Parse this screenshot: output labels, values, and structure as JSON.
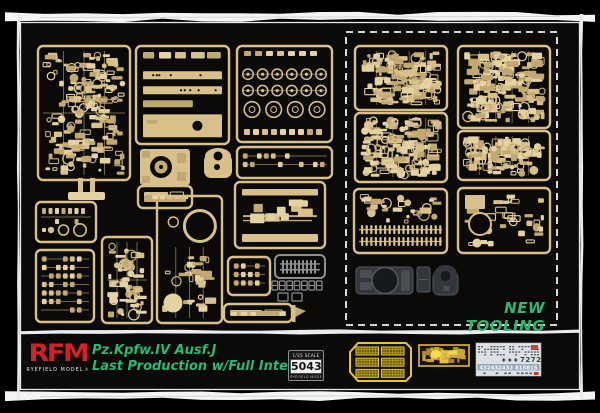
{
  "colors": {
    "background": "#000000",
    "panel": "#0b0a08",
    "sprue_tan": "#d8c08a",
    "sprue_tan_light": "#e5d2a3",
    "sprue_tan_dark": "#c2a971",
    "sprue_gray": "#8f8f8f",
    "dark_part": "#33363a",
    "dark_part_light": "#4a4e54",
    "frame_white": "#f4f4f4",
    "green": "#2db873",
    "red": "#d22128",
    "pe_yellow": "#e3c431",
    "pe_gold": "#c9a53b",
    "decal_bg": "#dce1e6",
    "decal_band": "#92a9bb",
    "decal_ink": "#3a4046",
    "decal_red": "#c63434"
  },
  "panel": {
    "new_tooling_label": "NEW TOOLING",
    "dashed_box": {
      "x": 346,
      "y": 32,
      "w": 211,
      "h": 293
    },
    "sprues": [
      {
        "id": "A",
        "x": 38,
        "y": 46,
        "w": 92,
        "h": 134,
        "kind": "mixed",
        "color": "tan",
        "seed": 1
      },
      {
        "id": "B",
        "x": 136,
        "y": 46,
        "w": 93,
        "h": 98,
        "kind": "plates",
        "color": "tan",
        "seed": 2
      },
      {
        "id": "C",
        "x": 237,
        "y": 46,
        "w": 95,
        "h": 96,
        "kind": "wheels",
        "color": "tan",
        "seed": 3
      },
      {
        "id": "D",
        "x": 237,
        "y": 147,
        "w": 95,
        "h": 31,
        "kind": "tiny",
        "color": "tan",
        "seed": 4
      },
      {
        "id": "E",
        "x": 36,
        "y": 202,
        "w": 60,
        "h": 40,
        "kind": "small-circles",
        "color": "tan",
        "seed": 5
      },
      {
        "id": "F",
        "x": 36,
        "y": 250,
        "w": 58,
        "h": 72,
        "kind": "tiny",
        "color": "tan",
        "seed": 6
      },
      {
        "id": "G",
        "x": 102,
        "y": 237,
        "w": 50,
        "h": 86,
        "kind": "mixed",
        "color": "tan",
        "seed": 7
      },
      {
        "id": "H",
        "x": 157,
        "y": 196,
        "w": 65,
        "h": 127,
        "kind": "bigcircle",
        "color": "tan",
        "seed": 8
      },
      {
        "id": "I",
        "x": 235,
        "y": 182,
        "w": 90,
        "h": 66,
        "kind": "barrels",
        "color": "tan",
        "seed": 9
      },
      {
        "id": "J",
        "x": 228,
        "y": 257,
        "w": 42,
        "h": 38,
        "kind": "tiny",
        "color": "tan",
        "seed": 10
      },
      {
        "id": "K",
        "x": 138,
        "y": 186,
        "w": 54,
        "h": 22,
        "kind": "strips",
        "color": "tan",
        "seed": 11
      },
      {
        "id": "L",
        "x": 224,
        "y": 304,
        "w": 68,
        "h": 18,
        "kind": "strips",
        "color": "tan",
        "seed": 12
      },
      {
        "id": "M",
        "x": 275,
        "y": 255,
        "w": 50,
        "h": 23,
        "kind": "combs",
        "color": "gray",
        "seed": 13
      },
      {
        "id": "N1",
        "x": 355,
        "y": 46,
        "w": 92,
        "h": 64,
        "kind": "dense",
        "color": "tan",
        "seed": 14
      },
      {
        "id": "N2",
        "x": 458,
        "y": 46,
        "w": 92,
        "h": 82,
        "kind": "dense",
        "color": "tan",
        "seed": 15
      },
      {
        "id": "N3",
        "x": 355,
        "y": 113,
        "w": 92,
        "h": 69,
        "kind": "dense",
        "color": "tan",
        "seed": 16
      },
      {
        "id": "N4",
        "x": 458,
        "y": 131,
        "w": 92,
        "h": 49,
        "kind": "dense",
        "color": "tan",
        "seed": 17
      },
      {
        "id": "N5",
        "x": 354,
        "y": 189,
        "w": 93,
        "h": 64,
        "kind": "dense-combs",
        "color": "tan",
        "seed": 18
      },
      {
        "id": "N6",
        "x": 458,
        "y": 188,
        "w": 92,
        "h": 65,
        "kind": "dense-circle",
        "color": "tan",
        "seed": 19
      }
    ],
    "loose_parts": [
      {
        "type": "pedestal",
        "x": 68,
        "y": 178,
        "w": 37,
        "h": 22
      },
      {
        "type": "hull-top",
        "x": 140,
        "y": 149,
        "w": 50,
        "h": 36
      },
      {
        "type": "turret-shell",
        "x": 204,
        "y": 147,
        "w": 28,
        "h": 31
      },
      {
        "type": "track-links",
        "x": 272,
        "y": 281,
        "w": 51,
        "h": 9
      },
      {
        "type": "track-pads",
        "x": 278,
        "y": 293,
        "w": 24,
        "h": 8
      },
      {
        "type": "flag-part",
        "x": 292,
        "y": 305,
        "w": 14,
        "h": 17
      },
      {
        "type": "hull-tub",
        "x": 356,
        "y": 264,
        "w": 57,
        "h": 33
      },
      {
        "type": "block",
        "x": 417,
        "y": 267,
        "w": 13,
        "h": 25
      },
      {
        "type": "turret-dark",
        "x": 433,
        "y": 264,
        "w": 25,
        "h": 33
      }
    ]
  },
  "footer": {
    "brand": {
      "logo_text": "RFM",
      "sub_text": "RYEFIELD MODEL",
      "reg_mark": "®"
    },
    "title_line1": "Pz.Kpfw.IV Ausf.J",
    "title_line2": "Last Production w/Full Interior",
    "badge": {
      "scale_text": "1/35 SCALE",
      "kit_number": "5043",
      "bottom_text": "RYEFIELD MODEL"
    },
    "pe_frets": [
      {
        "name": "mesh-grille-fret",
        "x": 350,
        "y": 343,
        "w": 61,
        "h": 38,
        "style": "mesh"
      },
      {
        "name": "detail-fret",
        "x": 419,
        "y": 345,
        "w": 50,
        "h": 21,
        "style": "parts"
      }
    ],
    "decal": {
      "x": 476,
      "y": 343,
      "w": 65,
      "h": 33,
      "crosses": "+ + +",
      "serial": "7272",
      "band_numbers": "432432432 815815"
    }
  }
}
